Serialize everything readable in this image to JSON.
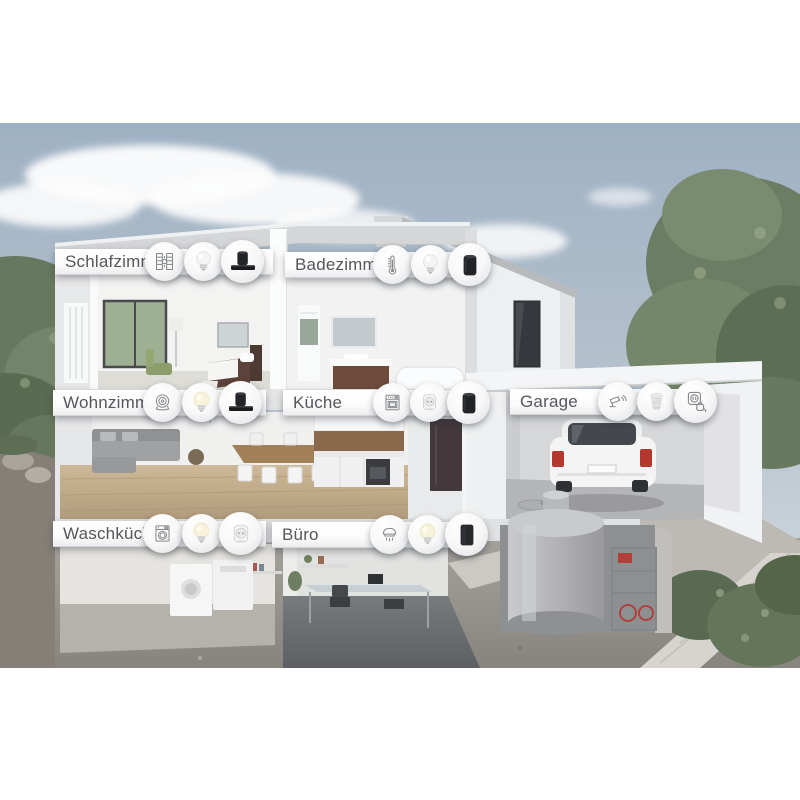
{
  "illustration": {
    "type": "smart-home-cutaway",
    "colors": {
      "sky": "#a8bacb",
      "house_wall": "#eef0f1",
      "ground": "#95928c",
      "foliage": "#6b7d62",
      "label_text": "#54575b",
      "car_taillight": "#b5382f",
      "device_dark": "#222428"
    }
  },
  "rooms": [
    {
      "id": "schlafzimmer",
      "label": "Schlafzimmer",
      "icons": [
        "roller-shutter-icon",
        "white-bulb-icon",
        "speaker-soundbar-icon"
      ]
    },
    {
      "id": "badezimmer",
      "label": "Badezimmer",
      "icons": [
        "thermometer-icon",
        "white-bulb-icon",
        "smart-speaker-icon"
      ]
    },
    {
      "id": "wohnzimmer",
      "label": "Wohnzimmer",
      "icons": [
        "speaker-rings-icon",
        "glow-bulb-icon",
        "speaker-soundbar-icon"
      ]
    },
    {
      "id": "kueche",
      "label": "Küche",
      "icons": [
        "oven-icon",
        "smart-plug-icon",
        "smart-speaker-icon"
      ]
    },
    {
      "id": "garage",
      "label": "Garage",
      "icons": [
        "security-camera-icon",
        "spot-bulb-icon",
        "socket-plug-icon"
      ]
    },
    {
      "id": "waschkueche",
      "label": "Waschküche",
      "icons": [
        "washing-machine-icon",
        "glow-bulb-icon",
        "smart-plug-icon"
      ]
    },
    {
      "id": "buero",
      "label": "Büro",
      "icons": [
        "smoke-detector-icon",
        "glow-bulb-icon",
        "box-speaker-icon"
      ]
    }
  ]
}
